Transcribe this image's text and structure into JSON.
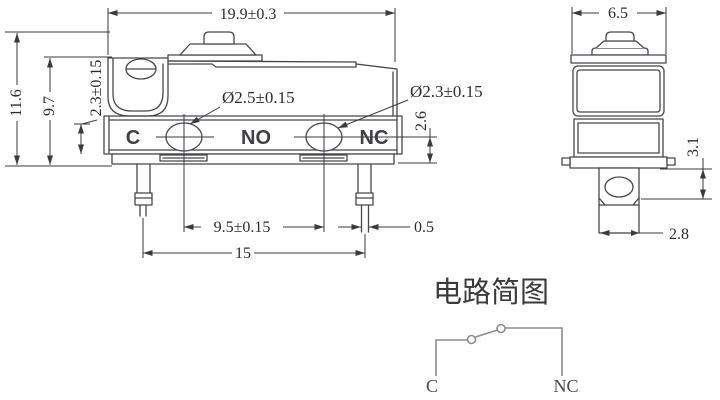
{
  "front_view": {
    "dim_width": "19.9±0.3",
    "dim_total_height": "11.6",
    "dim_body_height": "9.7",
    "dim_hole_offset": "2.3±0.15",
    "dim_hole1_diameter": "Ø2.5±0.15",
    "dim_hole2_diameter": "Ø2.3±0.15",
    "dim_center_to_bottom": "2.6",
    "dim_hole_spacing": "9.5±0.15",
    "dim_pin_thickness": "0.5",
    "dim_pin_spacing": "15",
    "terminal_c": "C",
    "terminal_no": "NO",
    "terminal_nc": "NC"
  },
  "side_view": {
    "dim_width": "6.5",
    "dim_terminal_height": "3.1",
    "dim_terminal_width": "2.8"
  },
  "circuit": {
    "title": "电路简图",
    "terminal_c": "C",
    "terminal_nc": "NC"
  },
  "colors": {
    "line": "#46464e",
    "dimension": "#3a3a42",
    "text": "#2b2b31",
    "circuit_line": "#8c8c8c",
    "background": "#ffffff"
  }
}
